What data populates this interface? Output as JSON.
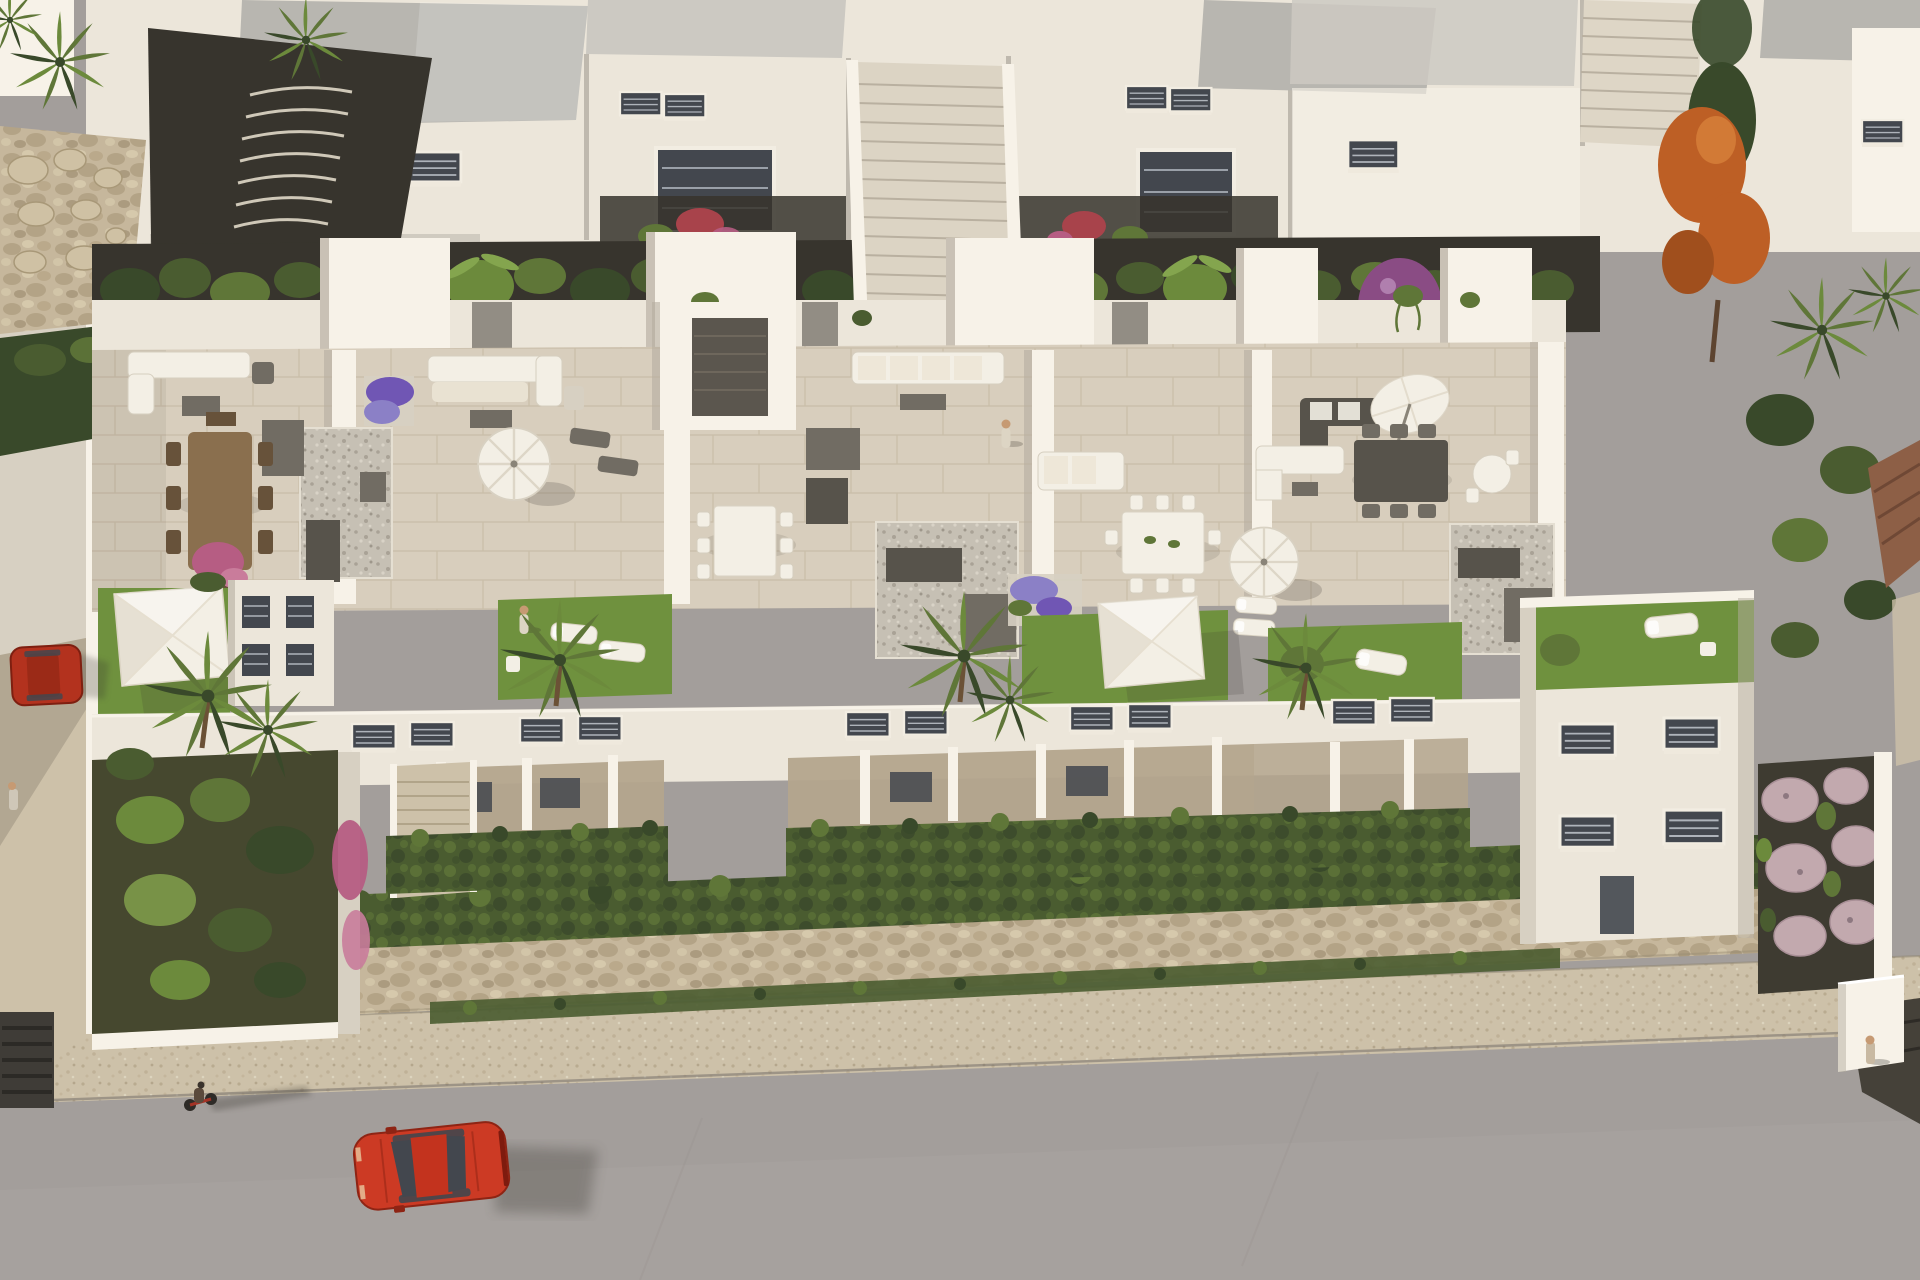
{
  "scene": {
    "subject": "Aerial 3D architectural rendering of a modern white residential complex with rooftop terraces, gardens and a street",
    "setting": "daytime render, warm sunlight, long shadows cast to the right",
    "elements": [
      "rear row of white apartment blocks with flat grey gravel roofs",
      "long central outdoor staircase between rear blocks",
      "second staircase at top right",
      "rock boulder retaining wall and curved dark path at top left",
      "dense hedge and tree band with banana plants between building rows",
      "orange autumn tree",
      "purple bougainvillea shrubs",
      "five rooftop terraces with beige tile floors and white parapets",
      "outdoor corner sofas, dining tables and chairs",
      "round white parasols and one tilted parasol",
      "white square shade sails over rooftop lawns",
      "grey pebble patio squares with dark benches and planter boxes",
      "rooftop lawns with sun loungers",
      "lower facades with dark louvered windows and shaded porches",
      "front gardens with palm trees and clipped hedges",
      "end villa with roof lawn and lounger",
      "garden of round pink gravel mounds with grasses",
      "beige stone perimeter wall topped with hedge",
      "stone sidewalk and grey asphalt street",
      "red car driving on the street with long shadow",
      "red car parked on the left side street",
      "cyclist on the street",
      "pedestrians on terrace, lawn, sidewalk and street"
    ],
    "counts": {
      "terrace_units": 5,
      "shade_sails": 3,
      "round_parasols": 3,
      "cars": 2,
      "bicycles": 1,
      "people": 5,
      "palm_tree_clusters": 9
    }
  },
  "colors": {
    "street": "#a39e9b",
    "streetl": "#aba5a2",
    "sidewalk": "#cdc1a9",
    "stone": "#c6b79c",
    "wsun": "#ece6da",
    "wbright": "#f7f2e8",
    "wshade": "#d7d0c2",
    "wdark": "#b5ada0",
    "roof": "#b8b6b0",
    "roofl": "#ccc9c2",
    "tile": "#d8cebd",
    "peb": "#c6c0b4",
    "lawn": "#6f913e",
    "lawnl": "#84a54e",
    "hedge": "#4a5c30",
    "hedgel": "#5f7638",
    "tdark": "#39492a",
    "banana": "#6c8a3c",
    "soil": "#37342d",
    "sail": "#f3efe5",
    "fgray": "#716c63",
    "fdark": "#57534b",
    "wood": "#8a6f4e",
    "woodd": "#67523a",
    "car": "#cc3a24",
    "card": "#8e2414",
    "glass": "#43474e",
    "skin": "#c69a73",
    "pink": "#b65d83",
    "red": "#a8434b",
    "purple": "#7056b4",
    "lav": "#8b80c6",
    "orange": "#bd5f25",
    "boug": "#8a4c84",
    "mound": "#c2a9ae",
    "shadow": "#38342d",
    "porch": "#b4a58d"
  }
}
